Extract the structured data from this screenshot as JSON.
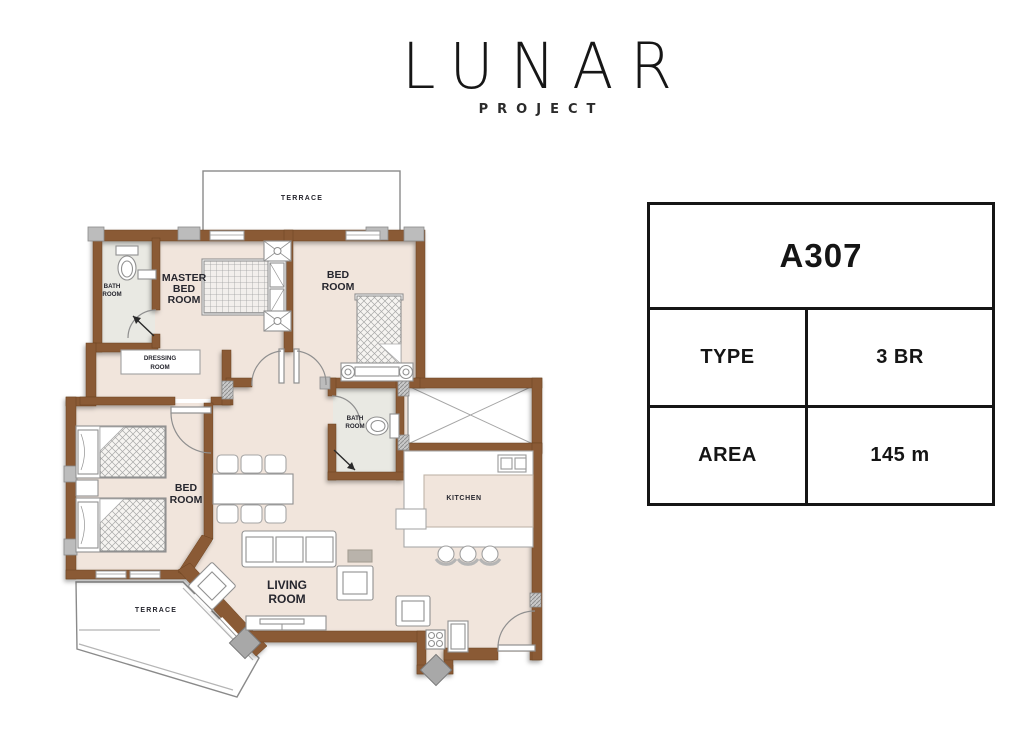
{
  "logo": {
    "title": "LUNAR",
    "subtitle": "PROJECT"
  },
  "unit_card": {
    "unit": "A307",
    "rows": [
      {
        "label": "TYPE",
        "value": "3 BR"
      },
      {
        "label": "AREA",
        "value": "145 m"
      }
    ]
  },
  "floor_plan": {
    "rooms": {
      "master_bedroom": [
        "MASTER",
        "BED",
        "ROOM"
      ],
      "bedroom_2": [
        "BED",
        "ROOM"
      ],
      "bedroom_3": [
        "BED",
        "ROOM"
      ],
      "living_room": [
        "LIVING",
        "ROOM"
      ],
      "kitchen": "KITCHEN",
      "bathroom_master": [
        "BATH",
        "ROOM"
      ],
      "bathroom_2": [
        "BATH",
        "ROOM"
      ],
      "dressing_room": [
        "DRESSING",
        "ROOM"
      ],
      "terrace_top": "TERRACE",
      "terrace_bottom": "TERRACE"
    },
    "colors": {
      "wall": "#8a5a36",
      "floor": "#f1e5dc",
      "bath_floor": "#e9e9e3",
      "label": "#26262e"
    }
  }
}
